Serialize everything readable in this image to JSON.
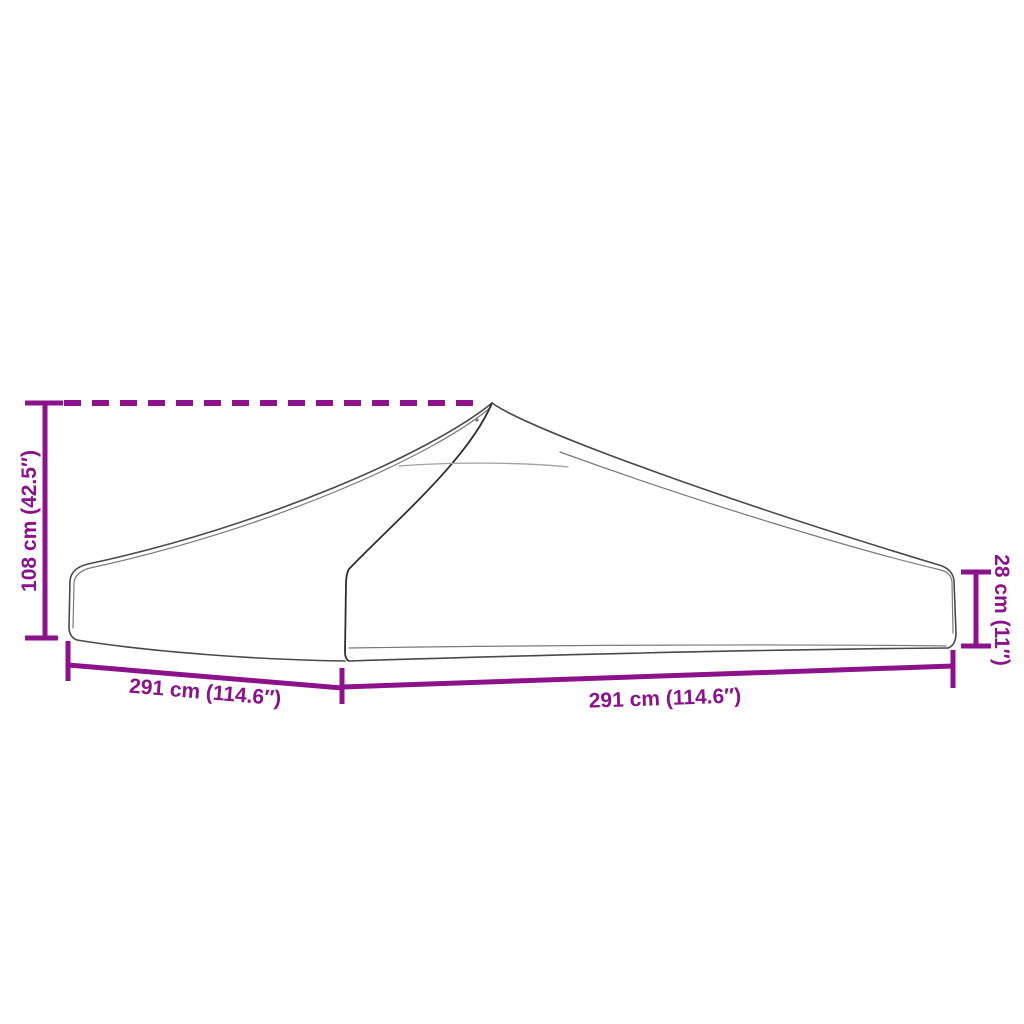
{
  "diagram": {
    "colors": {
      "dimension_accent": "#8B128B",
      "outline_gray": "#4a4a4a",
      "background": "#ffffff"
    },
    "labels": {
      "height_left": "108 cm (42.5″)",
      "height_right": "28 cm (11″)",
      "width_left": "291 cm (114.6″)",
      "width_right": "291 cm (114.6″)"
    }
  }
}
